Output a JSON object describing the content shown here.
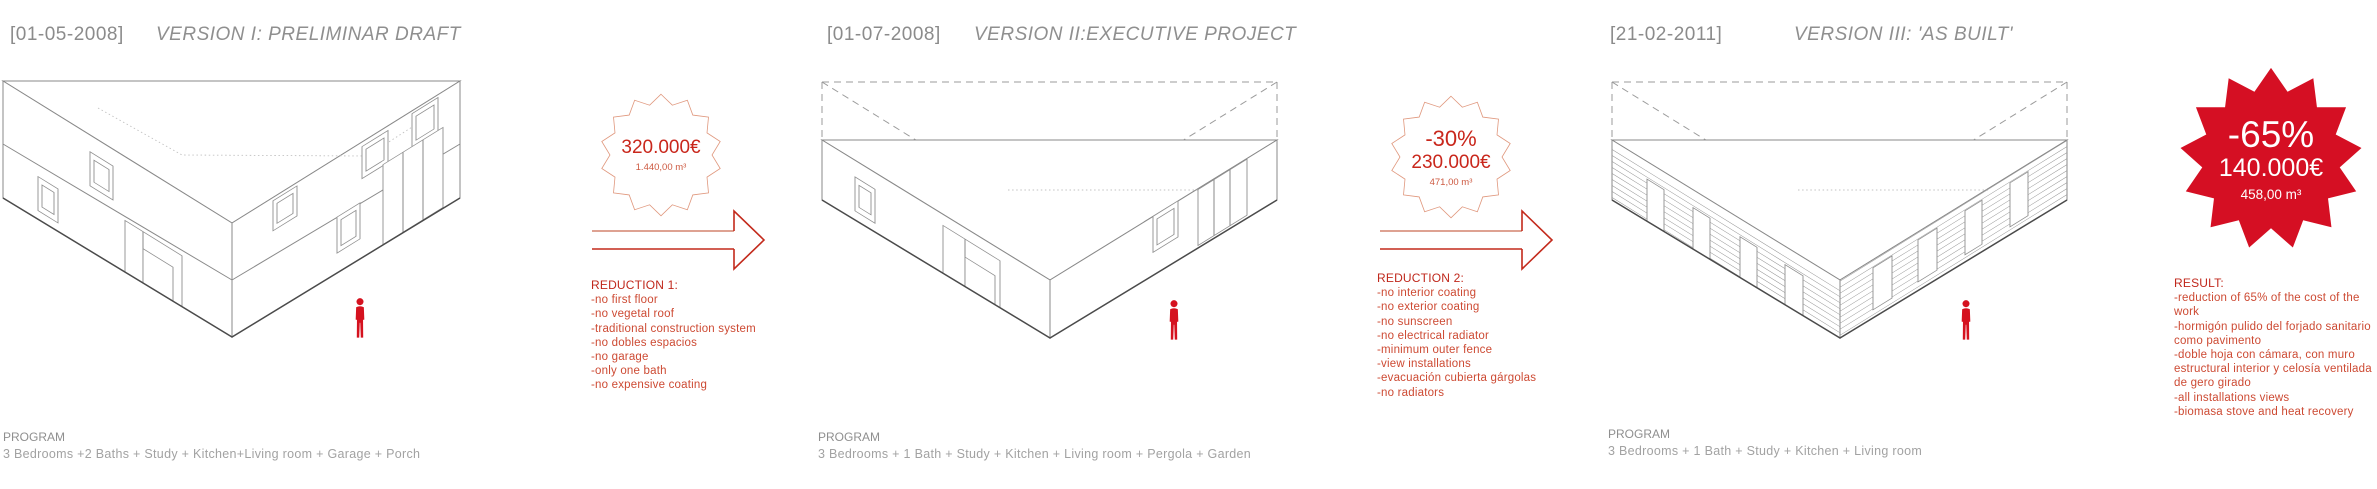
{
  "colors": {
    "accent_red": "#c9271c",
    "badge_fill_red": "#d50f23",
    "list_red": "#cd4a33",
    "drawing_gray": "#8a8a8a"
  },
  "sections": [
    {
      "date": "[01-05-2008]",
      "title": "VERSION I: PRELIMINAR DRAFT",
      "program_label": "PROGRAM",
      "program": "3 Bedrooms +2 Baths + Study + Kitchen+Living room + Garage + Porch"
    },
    {
      "date": "[01-07-2008]",
      "title": "VERSION II:EXECUTIVE PROJECT",
      "program_label": "PROGRAM",
      "program": "3 Bedrooms + 1 Bath + Study + Kitchen + Living room + Pergola + Garden"
    },
    {
      "date": "[21-02-2011]",
      "title": "VERSION III: 'AS BUILT'",
      "program_label": "PROGRAM",
      "program": "3 Bedrooms + 1 Bath + Study + Kitchen + Living room"
    }
  ],
  "transitions": [
    {
      "badge": {
        "price": "320.000€",
        "area": "1.440,00 m³"
      },
      "heading": "REDUCTION 1:",
      "items": [
        "-no first floor",
        "-no vegetal roof",
        "-traditional construction system",
        "-no dobles espacios",
        "-no garage",
        "-only one bath",
        "-no expensive coating"
      ]
    },
    {
      "badge": {
        "percent": "-30%",
        "price": "230.000€",
        "area": "471,00 m³"
      },
      "heading": "REDUCTION 2:",
      "items": [
        "-no interior coating",
        "-no exterior coating",
        "-no sunscreen",
        "-no electrical radiator",
        "-minimum outer fence",
        "-view installations",
        "-evacuación cubierta gárgolas",
        "-no radiators"
      ]
    }
  ],
  "result": {
    "badge": {
      "percent": "-65%",
      "price": "140.000€",
      "area": "458,00 m³"
    },
    "heading": "RESULT:",
    "items": [
      "-reduction of 65% of the cost of the work",
      "-hormigón pulido del forjado sanitario como pavimento",
      "-doble hoja con cámara, con muro estructural interior y celosía ventilada de gero girado",
      "-all installations views",
      "-biomasa stove and heat recovery"
    ]
  }
}
